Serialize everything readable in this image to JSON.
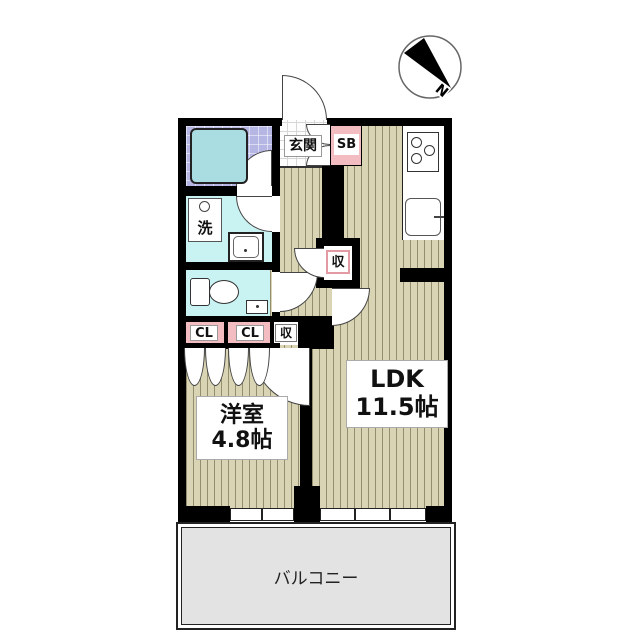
{
  "plan_title": "apartment-floor-plan",
  "compass": {
    "letter": "N"
  },
  "rooms": {
    "genkan": {
      "label": "玄関"
    },
    "shoebox": {
      "label": "SB"
    },
    "washer": {
      "label": "洗"
    },
    "closet1": {
      "label": "CL"
    },
    "closet2": {
      "label": "CL"
    },
    "storage_row": {
      "label": "収"
    },
    "storage_hall": {
      "label": "収"
    },
    "western": {
      "name": "洋室",
      "size": "4.8帖"
    },
    "ldk": {
      "name": "LDK",
      "size": "11.5帖"
    },
    "balcony": {
      "label": "バルコニー"
    }
  },
  "colors": {
    "wall": "#000000",
    "wood_floor": "#d9d4b3",
    "wood_stripe": "#a49f7d",
    "bath_tile": "#b6b6e4",
    "bathtub": "#a9dde1",
    "wet_floor": "#c9f2f2",
    "closet_pink": "#f3bcc1",
    "storage_label_border": "#e39aa2",
    "balcony_floor": "#e3e3e3",
    "genkan_tile": "#fdfdfd"
  }
}
